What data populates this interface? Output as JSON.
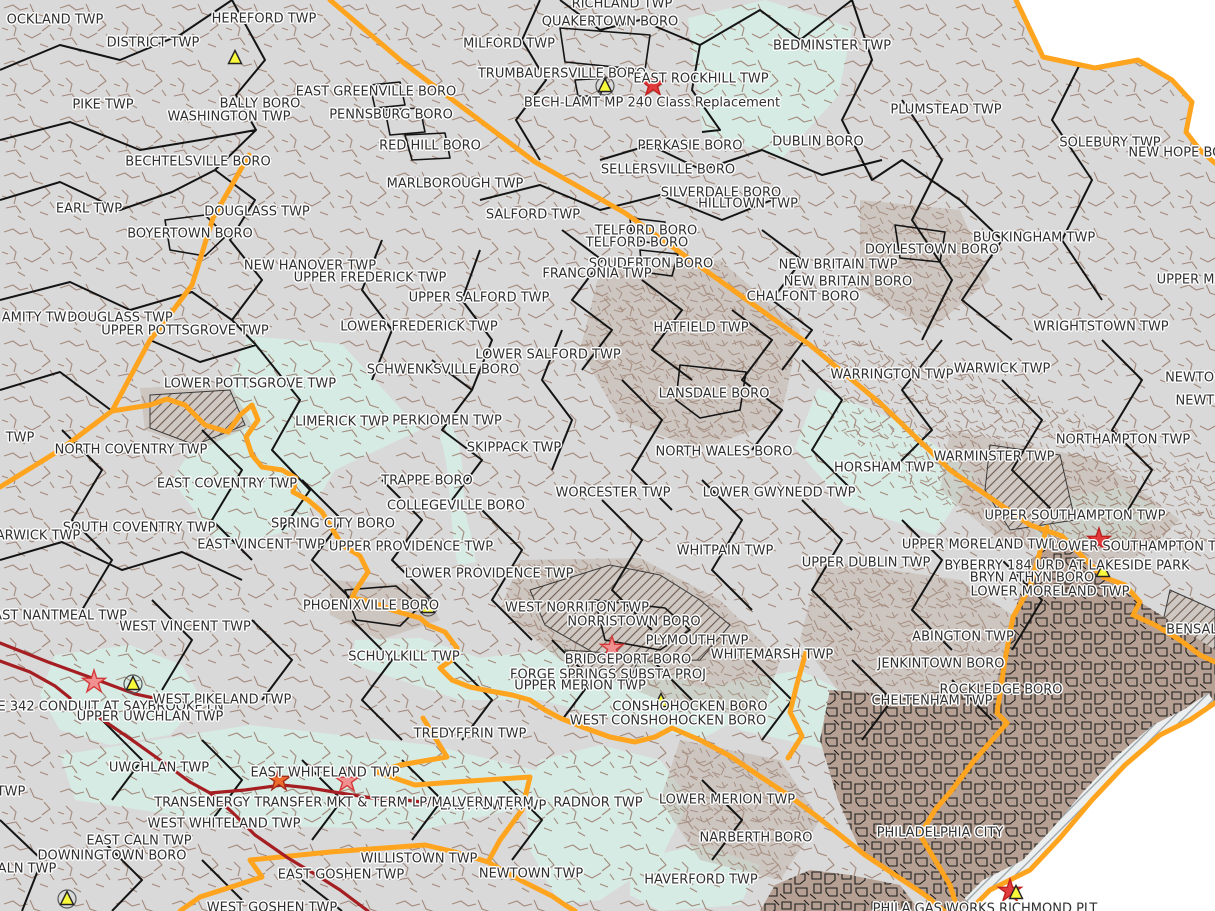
{
  "colors": {
    "land": "#d9d9d9",
    "outside": "#ffffff",
    "parcel": "#a3897b",
    "dense": "#b5a093",
    "water_cyan": "#d7ebe5",
    "county": "#ffa41e",
    "municipal": "#141414",
    "transmission": "#a51e22",
    "triangle": "#f9f93b",
    "label": "#2f2f2f"
  },
  "legend_marker_names": [
    "project-star-marker",
    "project-triangle-marker"
  ],
  "labels": [
    {
      "text": "OCKLAND TWP",
      "x": 55,
      "y": 20
    },
    {
      "text": "DISTRICT TWP",
      "x": 153,
      "y": 43
    },
    {
      "text": "HEREFORD TWP",
      "x": 264,
      "y": 19
    },
    {
      "text": "RICHLAND TWP",
      "x": 622,
      "y": 4
    },
    {
      "text": "QUAKERTOWN BORO",
      "x": 610,
      "y": 22
    },
    {
      "text": "MILFORD TWP",
      "x": 509,
      "y": 44
    },
    {
      "text": "BEDMINSTER TWP",
      "x": 832,
      "y": 46
    },
    {
      "text": "TRUMBAUERSVILLE BORO",
      "x": 562,
      "y": 74
    },
    {
      "text": "EAST ROCKHILL TWP",
      "x": 701,
      "y": 79
    },
    {
      "text": "BECH-LAMT MP 240 Class Replacement",
      "x": 652,
      "y": 103
    },
    {
      "text": "EAST GREENVILLE BORO",
      "x": 376,
      "y": 92
    },
    {
      "text": "PENNSBURG BORO",
      "x": 391,
      "y": 115
    },
    {
      "text": "BALLY BORO",
      "x": 260,
      "y": 104
    },
    {
      "text": "WASHINGTON TWP",
      "x": 229,
      "y": 117
    },
    {
      "text": "PIKE TWP",
      "x": 103,
      "y": 105
    },
    {
      "text": "PLUMSTEAD TWP",
      "x": 946,
      "y": 110
    },
    {
      "text": "DUBLIN BORO",
      "x": 818,
      "y": 142
    },
    {
      "text": "PERKASIE BORO",
      "x": 690,
      "y": 146
    },
    {
      "text": "RED HILL BORO",
      "x": 430,
      "y": 146
    },
    {
      "text": "SOLEBURY TWP",
      "x": 1110,
      "y": 143
    },
    {
      "text": "NEW HOPE BORO",
      "x": 1185,
      "y": 153
    },
    {
      "text": "BECHTELSVILLE BORO",
      "x": 198,
      "y": 162
    },
    {
      "text": "SELLERSVILLE BORO",
      "x": 668,
      "y": 170
    },
    {
      "text": "MARLBOROUGH TWP",
      "x": 455,
      "y": 184
    },
    {
      "text": "SILVERDALE BORO",
      "x": 721,
      "y": 193
    },
    {
      "text": "HILLTOWN TWP",
      "x": 748,
      "y": 204
    },
    {
      "text": "EARL TWP",
      "x": 89,
      "y": 209
    },
    {
      "text": "DOUGLASS TWP",
      "x": 257,
      "y": 212
    },
    {
      "text": "SALFORD TWP",
      "x": 533,
      "y": 215
    },
    {
      "text": "BOYERTOWN BORO",
      "x": 190,
      "y": 234
    },
    {
      "text": "TELFORD BORO",
      "x": 646,
      "y": 231
    },
    {
      "text": "TELFORD BORO",
      "x": 637,
      "y": 243
    },
    {
      "text": "DOYLESTOWN BORO",
      "x": 932,
      "y": 250
    },
    {
      "text": "BUCKINGHAM TWP",
      "x": 1034,
      "y": 238
    },
    {
      "text": "NEW HANOVER TWP",
      "x": 310,
      "y": 266
    },
    {
      "text": "UPPER FREDERICK TWP",
      "x": 370,
      "y": 278
    },
    {
      "text": "SOUDERTON BORO",
      "x": 651,
      "y": 264
    },
    {
      "text": "FRANCONIA TWP",
      "x": 597,
      "y": 274
    },
    {
      "text": "NEW BRITAIN TWP",
      "x": 838,
      "y": 265
    },
    {
      "text": "NEW BRITAIN BORO",
      "x": 848,
      "y": 282
    },
    {
      "text": "UPPER SALFORD TWP",
      "x": 479,
      "y": 298
    },
    {
      "text": "CHALFONT BORO",
      "x": 803,
      "y": 297
    },
    {
      "text": "UPPER MA",
      "x": 1190,
      "y": 280
    },
    {
      "text": "AMITY TWP",
      "x": 38,
      "y": 318
    },
    {
      "text": "DOUGLASS TWP",
      "x": 120,
      "y": 318
    },
    {
      "text": "UPPER POTTSGROVE TWP",
      "x": 185,
      "y": 331
    },
    {
      "text": "LOWER FREDERICK TWP",
      "x": 419,
      "y": 327
    },
    {
      "text": "HATFIELD TWP",
      "x": 701,
      "y": 328
    },
    {
      "text": "WRIGHTSTOWN TWP",
      "x": 1101,
      "y": 327
    },
    {
      "text": "LOWER SALFORD TWP",
      "x": 548,
      "y": 355
    },
    {
      "text": "SCHWENKSVILLE BORO",
      "x": 443,
      "y": 370
    },
    {
      "text": "LANSDALE BORO",
      "x": 714,
      "y": 394
    },
    {
      "text": "WARRINGTON TWP",
      "x": 892,
      "y": 375
    },
    {
      "text": "WARWICK TWP",
      "x": 1002,
      "y": 369
    },
    {
      "text": "NEWTOW",
      "x": 1196,
      "y": 378
    },
    {
      "text": "NEWTO",
      "x": 1200,
      "y": 401
    },
    {
      "text": "LOWER POTTSGROVE TWP",
      "x": 250,
      "y": 384
    },
    {
      "text": "LIMERICK TWP",
      "x": 342,
      "y": 422
    },
    {
      "text": "PERKIOMEN TWP",
      "x": 447,
      "y": 421
    },
    {
      "text": "NORTHAMPTON TWP",
      "x": 1123,
      "y": 440
    },
    {
      "text": "TWP",
      "x": 20,
      "y": 438
    },
    {
      "text": "NORTH COVENTRY TWP",
      "x": 131,
      "y": 450
    },
    {
      "text": "SKIPPACK TWP",
      "x": 514,
      "y": 448
    },
    {
      "text": "NORTH WALES BORO",
      "x": 724,
      "y": 452
    },
    {
      "text": "HORSHAM TWP",
      "x": 884,
      "y": 468
    },
    {
      "text": "WARMINSTER TWP",
      "x": 994,
      "y": 457
    },
    {
      "text": "EAST COVENTRY TWP",
      "x": 227,
      "y": 484
    },
    {
      "text": "TRAPPE BORO",
      "x": 427,
      "y": 481
    },
    {
      "text": "WORCESTER TWP",
      "x": 613,
      "y": 493
    },
    {
      "text": "LOWER GWYNEDD TWP",
      "x": 779,
      "y": 493
    },
    {
      "text": "COLLEGEVILLE BORO",
      "x": 456,
      "y": 506
    },
    {
      "text": "UPPER SOUTHAMPTON TWP",
      "x": 1075,
      "y": 516
    },
    {
      "text": "SOUTH COVENTRY TWP",
      "x": 139,
      "y": 528
    },
    {
      "text": "SPRING CITY BORO",
      "x": 333,
      "y": 524
    },
    {
      "text": "ARWICK TWP",
      "x": 38,
      "y": 536
    },
    {
      "text": "EAST VINCENT TWP",
      "x": 261,
      "y": 545
    },
    {
      "text": "UPPER PROVIDENCE TWP",
      "x": 411,
      "y": 547
    },
    {
      "text": "WHITPAIN TWP",
      "x": 725,
      "y": 551
    },
    {
      "text": "UPPER MORELAND TWP",
      "x": 979,
      "y": 545
    },
    {
      "text": "LOWER SOUTHAMPTON TW",
      "x": 1140,
      "y": 547
    },
    {
      "text": "UPPER DUBLIN TWP",
      "x": 866,
      "y": 563
    },
    {
      "text": "BYBERRY 184 URD AT LAKESIDE PARK",
      "x": 1067,
      "y": 566
    },
    {
      "text": "BRYN ATHYN BORO",
      "x": 1032,
      "y": 578
    },
    {
      "text": "LOWER MORELAND TWP",
      "x": 1050,
      "y": 592
    },
    {
      "text": "LOWER PROVIDENCE TWP",
      "x": 489,
      "y": 574
    },
    {
      "text": "EAST NANTMEAL TWP",
      "x": 56,
      "y": 616
    },
    {
      "text": "PHOENIXVILLE BORO",
      "x": 371,
      "y": 606
    },
    {
      "text": "WEST VINCENT TWP",
      "x": 185,
      "y": 627
    },
    {
      "text": "WEST NORRITON TWP",
      "x": 577,
      "y": 608
    },
    {
      "text": "NORRISTOWN BORO",
      "x": 634,
      "y": 622
    },
    {
      "text": "PLYMOUTH TWP",
      "x": 697,
      "y": 641
    },
    {
      "text": "ABINGTON TWP",
      "x": 963,
      "y": 637
    },
    {
      "text": "WHITEMARSH TWP",
      "x": 772,
      "y": 655
    },
    {
      "text": "SCHUYLKILL TWP",
      "x": 404,
      "y": 657
    },
    {
      "text": "BRIDGEPORT BORO",
      "x": 628,
      "y": 660
    },
    {
      "text": "JENKINTOWN BORO",
      "x": 941,
      "y": 664
    },
    {
      "text": "FORGE SPRINGS SUBSTA PROJ",
      "x": 608,
      "y": 675
    },
    {
      "text": "UPPER MERION TWP",
      "x": 580,
      "y": 686
    },
    {
      "text": "LE 342 CONDUIT AT SAYBROOKE LN",
      "x": 107,
      "y": 707
    },
    {
      "text": "WEST PIKELAND TWP",
      "x": 222,
      "y": 700
    },
    {
      "text": "UPPER UWCHLAN TWP",
      "x": 150,
      "y": 717
    },
    {
      "text": "CONSHOHOCKEN BORO",
      "x": 690,
      "y": 707
    },
    {
      "text": "ROCKLEDGE BORO",
      "x": 1001,
      "y": 690
    },
    {
      "text": "CHELTENHAM TWP",
      "x": 932,
      "y": 701
    },
    {
      "text": "WEST CONSHOHOCKEN BORO",
      "x": 668,
      "y": 721
    },
    {
      "text": "BENSALE",
      "x": 1196,
      "y": 630
    },
    {
      "text": "TREDYFFRIN TWP",
      "x": 470,
      "y": 734
    },
    {
      "text": "UWCHLAN TWP",
      "x": 159,
      "y": 768
    },
    {
      "text": "EAST WHITELAND TWP",
      "x": 325,
      "y": 773
    },
    {
      "text": "EASTTOWN TWP",
      "x": 493,
      "y": 806
    },
    {
      "text": "TRANSENERGY TRANSFER MKT & TERM LP/MALVERN TERM",
      "x": 344,
      "y": 803
    },
    {
      "text": "RADNOR TWP",
      "x": 598,
      "y": 803
    },
    {
      "text": "LOWER MERION TWP",
      "x": 727,
      "y": 800
    },
    {
      "text": "WEST WHITELAND TWP",
      "x": 224,
      "y": 824
    },
    {
      "text": "EAST CALN TWP",
      "x": 139,
      "y": 841
    },
    {
      "text": "DOWNINGTOWN BORO",
      "x": 112,
      "y": 856
    },
    {
      "text": "ALN TWP",
      "x": 27,
      "y": 869
    },
    {
      "text": "TWP",
      "x": 11,
      "y": 792
    },
    {
      "text": "NARBERTH BORO",
      "x": 756,
      "y": 838
    },
    {
      "text": "WILLISTOWN TWP",
      "x": 419,
      "y": 859
    },
    {
      "text": "EAST GOSHEN TWP",
      "x": 341,
      "y": 875
    },
    {
      "text": "NEWTOWN TWP",
      "x": 531,
      "y": 874
    },
    {
      "text": "HAVERFORD TWP",
      "x": 701,
      "y": 880
    },
    {
      "text": "WEST GOSHEN TWP",
      "x": 272,
      "y": 908
    },
    {
      "text": "PHILADELPHIA CITY",
      "x": 940,
      "y": 833
    },
    {
      "text": "PHILA GAS WORKS RICHMOND PLT",
      "x": 985,
      "y": 909
    }
  ],
  "markers": [
    {
      "type": "triangle",
      "x": 235,
      "y": 60,
      "circle": false
    },
    {
      "type": "triangle",
      "x": 605,
      "y": 88,
      "circle": true
    },
    {
      "type": "star",
      "x": 653,
      "y": 87,
      "fill": "#e23b3b",
      "stroke": "#c01f1f"
    },
    {
      "type": "star",
      "x": 1099,
      "y": 542,
      "fill": "#e23b3b",
      "stroke": "#c01f1f"
    },
    {
      "type": "triangle",
      "x": 1103,
      "y": 573,
      "circle": false
    },
    {
      "type": "triangle",
      "x": 428,
      "y": 609,
      "circle": true
    },
    {
      "type": "star",
      "x": 612,
      "y": 650,
      "fill": "#f09090",
      "stroke": "#d53a3a"
    },
    {
      "type": "star",
      "x": 94,
      "y": 684,
      "fill": "#f09090",
      "stroke": "#d53a3a"
    },
    {
      "type": "triangle",
      "x": 133,
      "y": 686,
      "circle": true
    },
    {
      "type": "triangle",
      "x": 661,
      "y": 703,
      "circle": false
    },
    {
      "type": "star",
      "x": 279,
      "y": 782,
      "fill": "#ec6c2d",
      "stroke": "#a52a1a"
    },
    {
      "type": "star",
      "x": 347,
      "y": 783,
      "fill": "#f09090",
      "stroke": "#d53a3a"
    },
    {
      "type": "triangle",
      "x": 67,
      "y": 901,
      "circle": true
    },
    {
      "type": "star",
      "x": 1010,
      "y": 893,
      "fill": "#e23b3b",
      "stroke": "#c01f1f"
    },
    {
      "type": "triangle",
      "x": 1016,
      "y": 895,
      "circle": false
    }
  ]
}
